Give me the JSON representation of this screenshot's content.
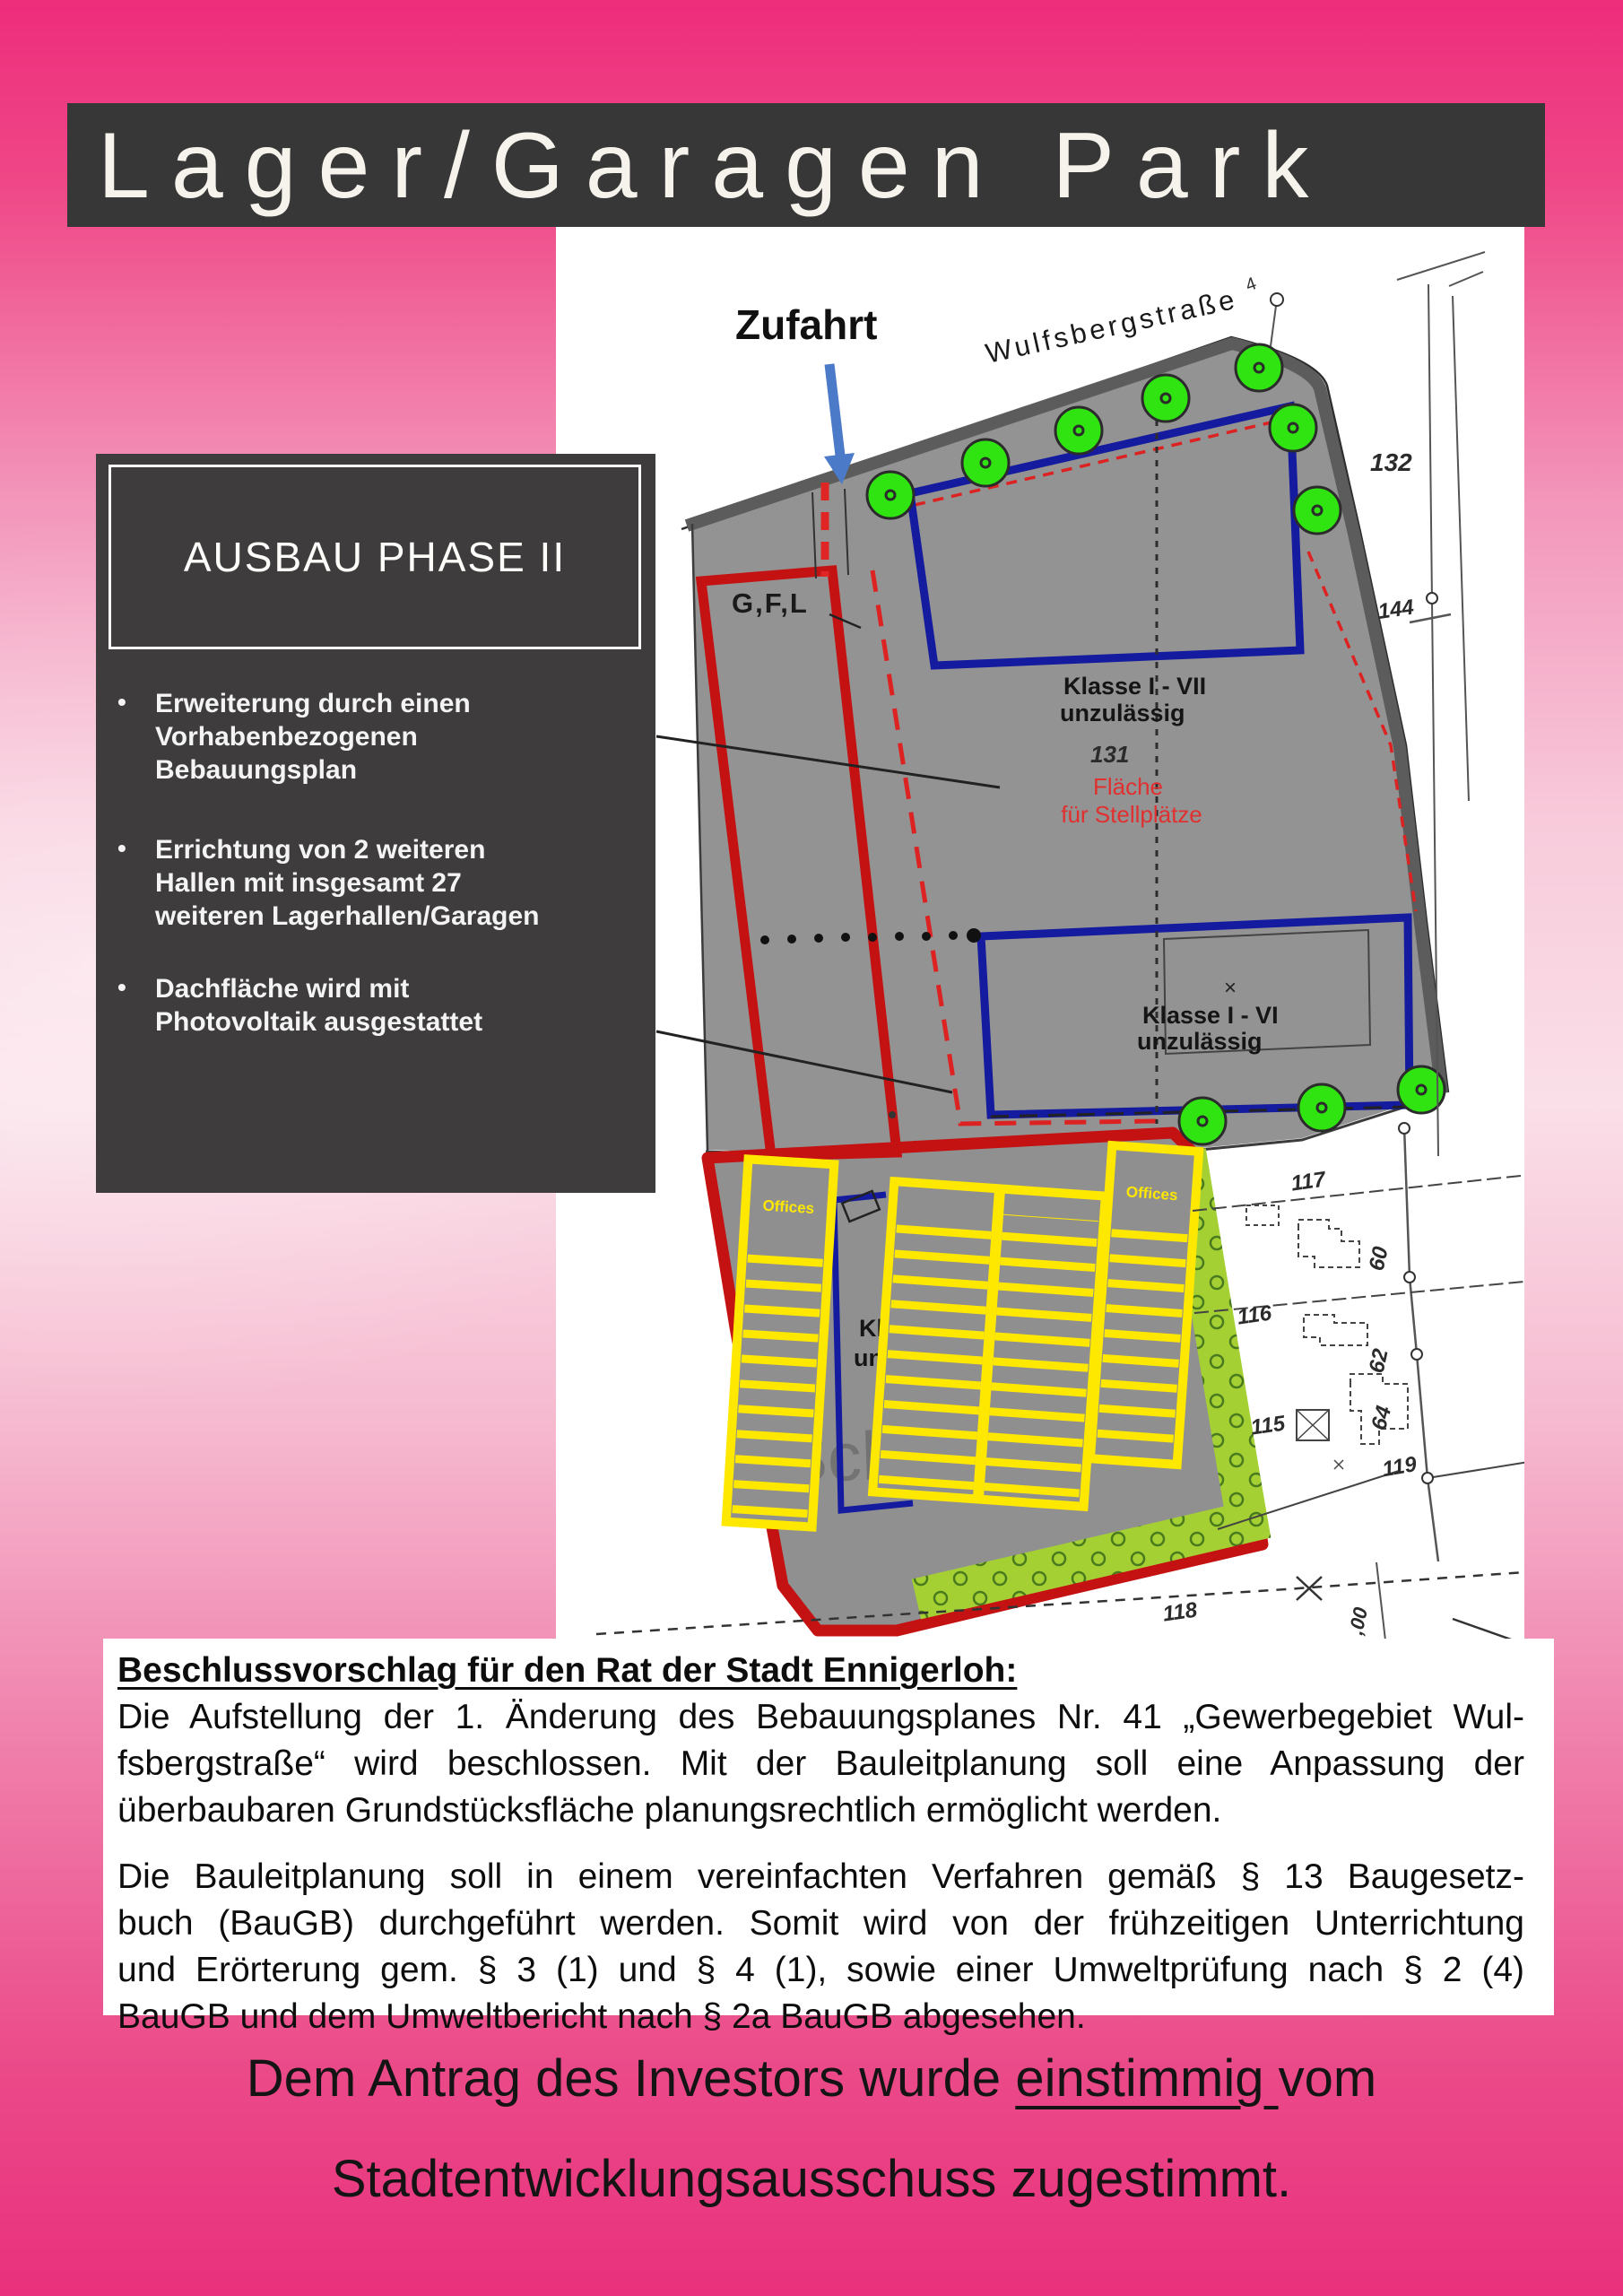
{
  "title": "Lager/Garagen Park",
  "phase_box": {
    "heading": "AUSBAU PHASE II",
    "bullets": [
      [
        "Erweiterung durch einen",
        "Vorhabenbezogenen",
        "Bebauungsplan"
      ],
      [
        "Errichtung von 2 weiteren",
        "Hallen mit insgesamt 27",
        "weiteren Lagerhallen/Garagen"
      ],
      [
        "Dachfläche wird mit",
        "Photovoltaik ausgestattet"
      ]
    ]
  },
  "map": {
    "labels": {
      "zufahrt": "Zufahrt",
      "strasse": "Wulfsbergstraße",
      "gfl": "G,F,L",
      "klasse7_line1": "Klasse I - VII",
      "klasse7_line2": "unzulässig",
      "n131": "131",
      "flaeche_line1": "Fläche",
      "flaeche_line2": "für Stellplätze",
      "klasse6_line1": "Klasse I - VI",
      "klasse6_line2": "unzulässig",
      "klasse6_low_line1": "Klasse I - VI",
      "klasse6_low_line2": "unzulässig",
      "xmark": "×",
      "offices": "Offices",
      "watermark": "Scherlau",
      "n4": "4",
      "p132": "132",
      "p144": "144",
      "p117": "117",
      "p116": "116",
      "p115": "115",
      "p118": "118",
      "p119": "119",
      "p60": "60",
      "p62": "62",
      "p64": "64",
      "m00": ",00"
    }
  },
  "resolution": {
    "heading": "Beschlussvorschlag für den Rat der Stadt Ennigerloh:",
    "para1": [
      "Die Aufstellung der 1. Änderung des Bebauungsplanes Nr. 41 „Gewerbegebiet Wul-",
      "fsbergstraße“ wird beschlossen. Mit der Bauleitplanung soll eine Anpassung der",
      "überbaubaren Grundstücksfläche planungsrechtlich ermöglicht werden."
    ],
    "para2": [
      "Die Bauleitplanung soll in einem vereinfachten Verfahren gemäß § 13 Baugesetz-",
      "buch (BauGB) durchgeführt werden. Somit wird von der frühzeitigen Unterrichtung",
      "und Erörterung gem. § 3 (1) und § 4 (1), sowie einer Umweltprüfung nach § 2 (4)",
      "BauGB und dem Umweltbericht nach § 2a BauGB abgesehen."
    ]
  },
  "closing": {
    "line1_pre": "Dem Antrag des Investors wurde ",
    "line1_underlined": "einstimmig ",
    "line1_post": "vom",
    "line2": "Stadtentwicklungsausschuss zugestimmt."
  },
  "colors": {
    "pink_top": "#ee2d7b",
    "pink_light": "#fadfe8",
    "banner_bg": "#373737",
    "box_bg": "#3e3c3d",
    "site_gray": "#939393",
    "boundary_red": "#c41212",
    "building_blue": "#141b9e",
    "tree_green": "#2fe411",
    "hedge_green": "#a4d033",
    "structure_yellow": "#ffe800",
    "label_red": "#e03030"
  }
}
